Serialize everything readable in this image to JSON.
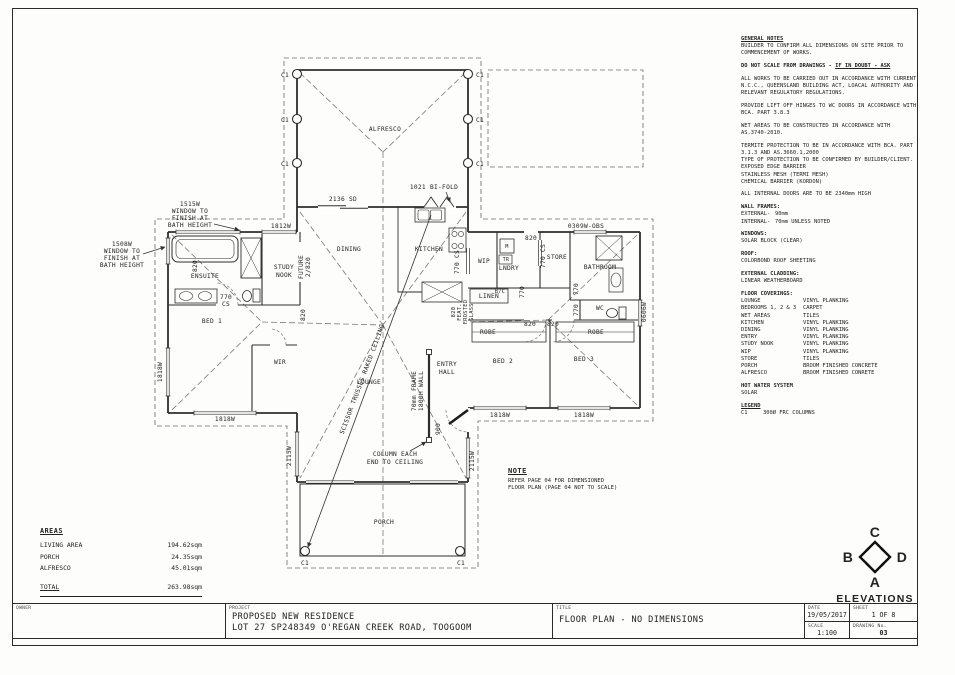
{
  "sheet": {
    "owner_label": "OWNER",
    "project_label": "PROJECT",
    "project_line1": "PROPOSED NEW RESIDENCE",
    "project_line2": "LOT 27 SP248349 O'REGAN CREEK ROAD, TOOGOOM",
    "title_label": "TITLE",
    "title": "FLOOR PLAN - NO DIMENSIONS",
    "date_label": "DATE",
    "date": "19/05/2017",
    "sheet_label": "SHEET",
    "sheet_no": "1 OF 8",
    "scale_label": "SCALE",
    "scale": "1:100",
    "drawing_label": "DRAWING No.",
    "drawing_no": "03"
  },
  "notes": {
    "blocks": [
      {
        "head": "GENERAL NOTES",
        "u": true,
        "lines": [
          "BUILDER TO CONFIRM ALL DIMENSIONS ON SITE PRIOR TO",
          "COMMENCEMENT OF WORKS."
        ]
      },
      {
        "bold": "DO NOT SCALE FROM DRAWINGS - ",
        "boldu": "IF IN DOUBT - ASK"
      },
      {
        "lines": [
          "ALL WORKS TO BE CARRIED OUT IN ACCORDANCE WITH CURRENT",
          "N.C.C., QUEENSLAND BUILDING ACT, LOACAL AUTHORITY AND",
          "RELEVANT REGULATORY REGULATIONS."
        ]
      },
      {
        "lines": [
          "PROVIDE LIFT OFF HINGES TO WC DOORS IN ACCORDANCE WITH",
          "BCA. PART 3.8.3"
        ]
      },
      {
        "lines": [
          "WET AREAS TO BE CONSTRUCTED IN ACCORDANCE WITH",
          "AS.3740-2010."
        ]
      },
      {
        "lines": [
          "TERMITE PROTECTION TO BE IN ACCORDANCE WITH BCA. PART",
          "3.1.3  AND AS.3660.1,2000",
          "TYPE OF PROTECTION TO BE CONFIRMED BY BUILDER/CLIENT.",
          "EXPOSED EDGE BARRIER",
          "STAINLESS MESH (TERMI MESH)",
          "CHEMICAL BARRIER (KORDON)"
        ]
      },
      {
        "lines": [
          "ALL INTERNAL DOORS ARE TO BE 2340mm HIGH"
        ]
      },
      {
        "head": "WALL FRAMES:",
        "kw": 34,
        "rows": [
          [
            "EXTERNAL-",
            "90mm"
          ],
          [
            "INTERNAL-",
            "70mm UNLESS NOTED"
          ]
        ]
      },
      {
        "head": "WINDOWS:",
        "lines": [
          "SOLAR BLOCK (CLEAR)"
        ]
      },
      {
        "head": "ROOF:",
        "lines": [
          "COLORBOND ROOF SHEETING"
        ]
      },
      {
        "head": "EXTERNAL CLADDING:",
        "lines": [
          "LINEAR WEATHERBOARD"
        ]
      },
      {
        "head": "FLOOR COVERINGS:",
        "kw": 62,
        "rows": [
          [
            "LOUNGE",
            "VINYL PLANKING"
          ],
          [
            "BEDROOMS 1, 2 & 3",
            "CARPET"
          ],
          [
            "WET AREAS",
            "TILES"
          ],
          [
            "KITCHEN",
            "VINYL PLANKING"
          ],
          [
            "DINING",
            "VINYL PLANKING"
          ],
          [
            "ENTRY",
            "VINYL PLANKING"
          ],
          [
            "STUDY NOOK",
            "VINYL PLANKING"
          ],
          [
            "WIP",
            "VINYL PLANKING"
          ],
          [
            "STORE",
            "TILES"
          ],
          [
            "PORCH",
            "BROOM FINISHED CONCRETE"
          ],
          [
            "ALFRESCO",
            "BROOM FINISHED CONRETE"
          ]
        ]
      },
      {
        "head": "HOT WATER SYSTEM",
        "lines": [
          "SOLAR"
        ]
      },
      {
        "head": "LEGEND",
        "u": true,
        "kw": 22,
        "rows": [
          [
            "C1",
            "300Ø FRC COLUMNS"
          ]
        ]
      }
    ]
  },
  "areas": {
    "title": "AREAS",
    "rows": [
      {
        "k": "LIVING AREA",
        "v": "194.62sqm"
      },
      {
        "k": "PORCH",
        "v": "24.35sqm"
      },
      {
        "k": "ALFRESCO",
        "v": "45.01sqm"
      }
    ],
    "total_label": "TOTAL",
    "total": "263.98sqm"
  },
  "note_box": {
    "title": "NOTE",
    "lines": [
      "REFER PAGE 04 FOR DIMENSIONED",
      "FLOOR PLAN (PAGE 04 NOT TO SCALE)"
    ]
  },
  "elevations": {
    "title": "ELEVATIONS",
    "letters": {
      "top": "C",
      "left": "B",
      "right": "D",
      "bottom": "A"
    }
  },
  "plan": {
    "labels": [
      {
        "t": "ALFRESCO",
        "x": 385,
        "y": 131
      },
      {
        "t": "C1",
        "x": 289,
        "y": 77,
        "a": "e"
      },
      {
        "t": "C1",
        "x": 289,
        "y": 122,
        "a": "e"
      },
      {
        "t": "C1",
        "x": 289,
        "y": 166,
        "a": "e"
      },
      {
        "t": "C1",
        "x": 476,
        "y": 77,
        "a": "s"
      },
      {
        "t": "C1",
        "x": 476,
        "y": 122,
        "a": "s"
      },
      {
        "t": "C1",
        "x": 476,
        "y": 166,
        "a": "s"
      },
      {
        "t": "2136 SD",
        "x": 343,
        "y": 201
      },
      {
        "t": "1021 BI-FOLD",
        "x": 434,
        "y": 189
      },
      {
        "t": "1515W",
        "x": 190,
        "y": 206
      },
      {
        "t": "WINDOW TO",
        "x": 190,
        "y": 213
      },
      {
        "t": "FINISH AT",
        "x": 190,
        "y": 220
      },
      {
        "t": "BATH HEIGHT",
        "x": 190,
        "y": 227
      },
      {
        "t": "1508W",
        "x": 122,
        "y": 246
      },
      {
        "t": "WINDOW TO",
        "x": 122,
        "y": 253
      },
      {
        "t": "FINISH AT",
        "x": 122,
        "y": 260
      },
      {
        "t": "BATH HEIGHT",
        "x": 122,
        "y": 267
      },
      {
        "t": "1812W",
        "x": 281,
        "y": 228
      },
      {
        "t": "ENSUITE",
        "x": 205,
        "y": 278
      },
      {
        "t": "820",
        "x": 197,
        "y": 266,
        "r": -90
      },
      {
        "t": "770",
        "x": 226,
        "y": 299
      },
      {
        "t": "CS",
        "x": 226,
        "y": 306
      },
      {
        "t": "STUDY",
        "x": 284,
        "y": 269
      },
      {
        "t": "NOOK",
        "x": 284,
        "y": 277
      },
      {
        "t": "FUTURE",
        "x": 303,
        "y": 267,
        "r": -90
      },
      {
        "t": "2/820",
        "x": 310,
        "y": 267,
        "r": -90
      },
      {
        "t": "DINING",
        "x": 349,
        "y": 251
      },
      {
        "t": "KITCHEN",
        "x": 429,
        "y": 251
      },
      {
        "t": "770 CS",
        "x": 459,
        "y": 262,
        "r": -90
      },
      {
        "t": "WIP",
        "x": 484,
        "y": 263
      },
      {
        "t": "B/C",
        "x": 500,
        "y": 293,
        "s": 5.2
      },
      {
        "t": "LINEN",
        "x": 489,
        "y": 298
      },
      {
        "t": "820",
        "x": 531,
        "y": 240
      },
      {
        "t": "LNDRY",
        "x": 509,
        "y": 270
      },
      {
        "t": "M",
        "x": 507,
        "y": 248,
        "s": 5.2
      },
      {
        "t": "TR",
        "x": 506,
        "y": 261,
        "s": 4.8
      },
      {
        "t": "770 CS",
        "x": 545,
        "y": 256,
        "r": -90
      },
      {
        "t": "STORE",
        "x": 557,
        "y": 259
      },
      {
        "t": "0309W-OBS",
        "x": 586,
        "y": 228
      },
      {
        "t": "BATHROOM",
        "x": 600,
        "y": 269
      },
      {
        "t": "770",
        "x": 524,
        "y": 292,
        "r": -90
      },
      {
        "t": "770",
        "x": 578,
        "y": 289,
        "r": -90
      },
      {
        "t": "770",
        "x": 578,
        "y": 310,
        "r": -90
      },
      {
        "t": "WC",
        "x": 600,
        "y": 310
      },
      {
        "t": "0606W",
        "x": 646,
        "y": 312,
        "r": -90
      },
      {
        "t": "820",
        "x": 530,
        "y": 326
      },
      {
        "t": "820",
        "x": 553,
        "y": 326
      },
      {
        "t": "ROBE",
        "x": 488,
        "y": 334
      },
      {
        "t": "ROBE",
        "x": 596,
        "y": 334
      },
      {
        "t": "820",
        "x": 455,
        "y": 312,
        "r": -90,
        "s": 5.4
      },
      {
        "t": "FEAT.",
        "x": 461,
        "y": 312,
        "r": -90,
        "s": 5.4
      },
      {
        "t": "FROSTED",
        "x": 467,
        "y": 312,
        "r": -90,
        "s": 5.4
      },
      {
        "t": "GLASS",
        "x": 473,
        "y": 312,
        "r": -90,
        "s": 5.4
      },
      {
        "t": "BED 2",
        "x": 503,
        "y": 363
      },
      {
        "t": "BED 3",
        "x": 584,
        "y": 361
      },
      {
        "t": "1818W",
        "x": 500,
        "y": 417
      },
      {
        "t": "1818W",
        "x": 584,
        "y": 417
      },
      {
        "t": "BED 1",
        "x": 212,
        "y": 323
      },
      {
        "t": "WIR",
        "x": 280,
        "y": 364
      },
      {
        "t": "820",
        "x": 305,
        "y": 315,
        "r": -90
      },
      {
        "t": "1818W",
        "x": 162,
        "y": 372,
        "r": -90
      },
      {
        "t": "1818W",
        "x": 225,
        "y": 421
      },
      {
        "t": "LOUNGE",
        "x": 369,
        "y": 384
      },
      {
        "t": "ENTRY",
        "x": 447,
        "y": 366
      },
      {
        "t": "HALL",
        "x": 447,
        "y": 374
      },
      {
        "t": "70mm FRAME",
        "x": 416,
        "y": 391,
        "r": -90
      },
      {
        "t": "1800H WALL",
        "x": 423,
        "y": 391,
        "r": -90
      },
      {
        "t": "COLUMN EACH",
        "x": 395,
        "y": 456
      },
      {
        "t": "END TO CEILING",
        "x": 395,
        "y": 464
      },
      {
        "t": "900",
        "x": 440,
        "y": 429,
        "r": -90
      },
      {
        "t": "2115W",
        "x": 291,
        "y": 456,
        "r": -90
      },
      {
        "t": "2115W",
        "x": 474,
        "y": 461,
        "r": -90
      },
      {
        "t": "SCISSOR TRUSSES RAKED CEILING",
        "x": 364,
        "y": 380,
        "r": -69.5
      },
      {
        "t": "PORCH",
        "x": 384,
        "y": 524
      },
      {
        "t": "C1",
        "x": 305,
        "y": 565
      },
      {
        "t": "C1",
        "x": 461,
        "y": 565
      }
    ]
  }
}
